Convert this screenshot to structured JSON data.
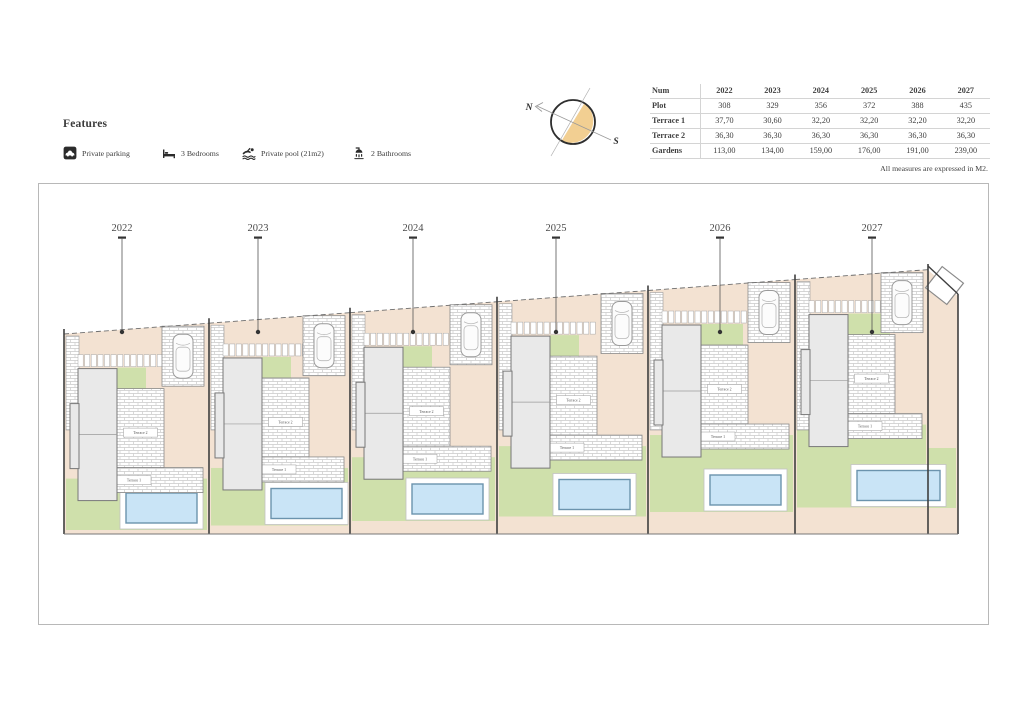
{
  "features": {
    "heading": "Features",
    "items": [
      {
        "icon": "parking-icon",
        "label": "Private parking"
      },
      {
        "icon": "bed-icon",
        "label": "3 Bedrooms"
      },
      {
        "icon": "pool-icon",
        "label": "Private pool (21m2)"
      },
      {
        "icon": "bathroom-icon",
        "label": "2 Bathrooms"
      }
    ]
  },
  "compass": {
    "north_label": "N",
    "south_label": "S"
  },
  "table": {
    "header": [
      "Num",
      "2022",
      "2023",
      "2024",
      "2025",
      "2026",
      "2027"
    ],
    "rows": [
      {
        "label": "Plot",
        "values": [
          "308",
          "329",
          "356",
          "372",
          "388",
          "435"
        ]
      },
      {
        "label": "Terrace 1",
        "values": [
          "37,70",
          "30,60",
          "32,20",
          "32,20",
          "32,20",
          "32,20"
        ]
      },
      {
        "label": "Terrace 2",
        "values": [
          "36,30",
          "36,30",
          "36,30",
          "36,30",
          "36,30",
          "36,30"
        ]
      },
      {
        "label": "Gardens",
        "values": [
          "113,00",
          "134,00",
          "159,00",
          "176,00",
          "191,00",
          "239,00"
        ]
      }
    ],
    "note": "All measures are expressed in M2."
  },
  "plan": {
    "plots": [
      {
        "number": "2022"
      },
      {
        "number": "2023"
      },
      {
        "number": "2024"
      },
      {
        "number": "2025"
      },
      {
        "number": "2026"
      },
      {
        "number": "2027"
      }
    ],
    "terrace_labels": {
      "upper": "Terrace 2",
      "lower": "Terrace 1"
    },
    "colors": {
      "ground": "#f3e2d2",
      "garden": "#cfe0ab",
      "pool_water": "#c9e4f6",
      "pool_border": "#6b93ad",
      "building": "#e9e9e9",
      "compass_fill": "#f2cf92",
      "outline": "#3f3f3f"
    }
  }
}
